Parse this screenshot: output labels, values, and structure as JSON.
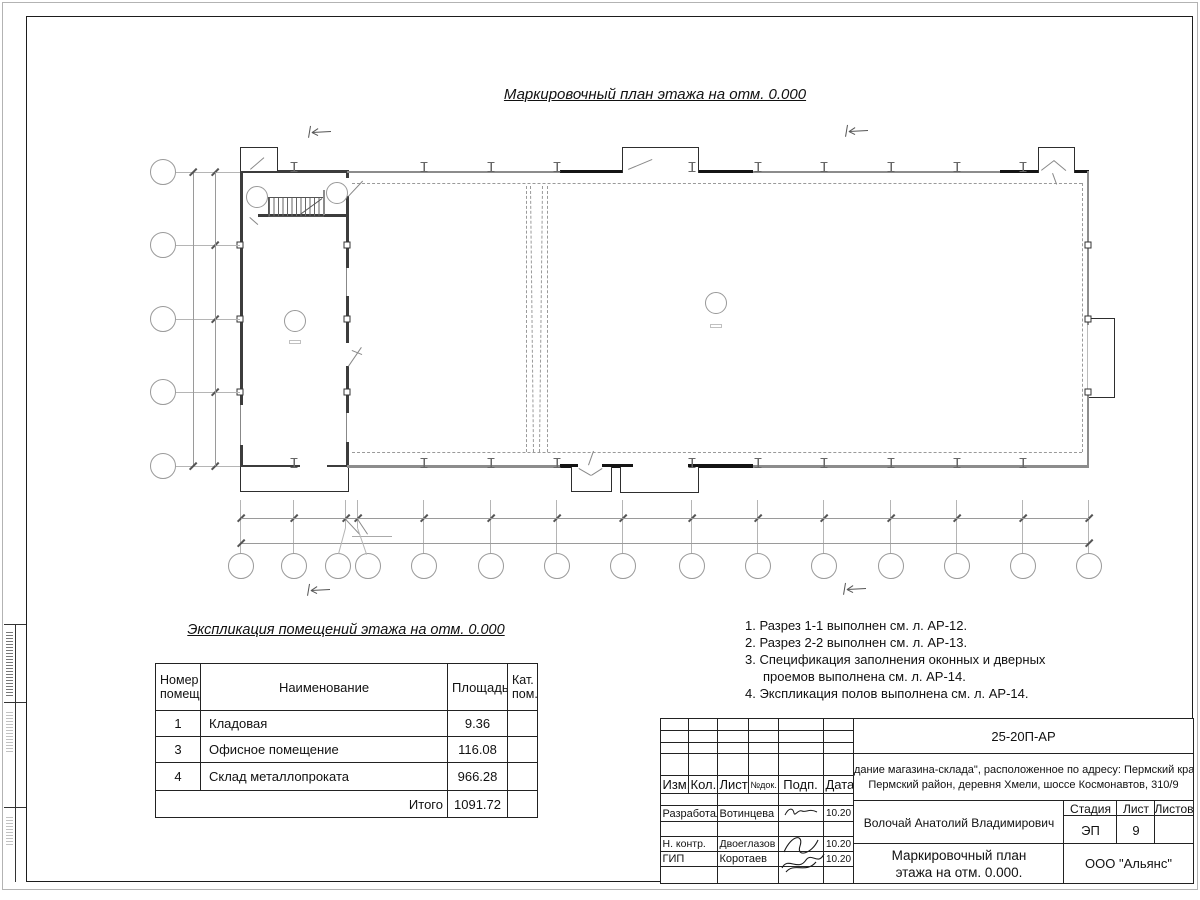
{
  "title": "Маркировочный план этажа на отм. 0.000",
  "plan": {
    "axes_numbers": [
      "1",
      "2",
      "3",
      "4",
      "5",
      "6",
      "7",
      "8",
      "9",
      "10",
      "11",
      "12",
      "13",
      "14",
      "15"
    ],
    "axes_letters": [
      "Д",
      "Г",
      "В",
      "Б",
      "А"
    ],
    "dims_bottom": [
      "3500",
      "3500",
      "4400",
      "4400",
      "4400",
      "4400",
      "4600",
      "4400",
      "4400",
      "4400",
      "4400",
      "4400",
      "4400"
    ],
    "dim_small": "800",
    "dim_total_bottom": "56400",
    "dims_left": [
      "4900",
      "4900",
      "4900",
      "4900"
    ],
    "dim_total_left": "19600",
    "labels": {
      "d3_topleft": "Д3",
      "d4": "Д4",
      "d5": "Д5",
      "ok1_top": "ОК1",
      "v1_top": "В1",
      "ok2_top": "ОК2",
      "d3_topright": "Д3",
      "ok4_upper": "ОК4",
      "crane": "Q=5т",
      "d6": "Д6",
      "v1_right": "В1",
      "ok5_left": "ОК5",
      "ok4_lower": "ОК4",
      "ok5_bottom": "ОК5",
      "d1": "Д1",
      "ok1_bottom": "ОК1",
      "d2": "Д2",
      "v1_bottom": "В1",
      "ok2_bottom": "ОК2"
    },
    "room_tags": [
      "1",
      "2",
      "3",
      "4"
    ],
    "elevation": "0.000",
    "sections": {
      "s1": "1",
      "s2": "2"
    }
  },
  "expl_table": {
    "title": "Экспликация помещений этажа на отм. 0.000",
    "headers": [
      "Номер помещ.",
      "Наименование",
      "Площадь",
      "Кат. пом."
    ],
    "rows": [
      [
        "1",
        "Кладовая",
        "9.36",
        ""
      ],
      [
        "3",
        "Офисное помещение",
        "116.08",
        ""
      ],
      [
        "4",
        "Склад металлопроката",
        "966.28",
        ""
      ]
    ],
    "total_label": "Итого",
    "total_value": "1091.72"
  },
  "notes": [
    "1. Разрез 1-1 выполнен см. л. АР-12.",
    "2. Разрез 2-2 выполнен см. л. АР-13.",
    "3. Спецификация заполнения оконных и дверных проемов выполнена см. л. АР-14.",
    "4. Экспликация полов выполнена см. л. АР-14."
  ],
  "titleblock": {
    "doc_code": "25-20П-АР",
    "project_line1": "\"Здание магазина-склада\", расположенное по адресу: Пермский край,",
    "project_line2": "Пермский район, деревня Хмели, шоссе Космонавтов, 310/9",
    "header_cols": [
      "Изм.",
      "Кол.",
      "Лист",
      "№док.",
      "Подп.",
      "Дата"
    ],
    "sign_rows": [
      [
        "Разработал",
        "Вотинцева",
        "10.20"
      ],
      [
        "Н. контр.",
        "Двоеглазов",
        "10.20"
      ],
      [
        "ГИП",
        "Коротаев",
        "10.20"
      ]
    ],
    "supervisor": "Волочай Анатолий Владимирович",
    "drawing_name_line1": "Маркировочный план",
    "drawing_name_line2": "этажа на отм. 0.000.",
    "stage_label": "Стадия",
    "sheet_label": "Лист",
    "sheets_label": "Листов",
    "stage": "ЭП",
    "sheet_no": "9",
    "sheets_total": "",
    "company": "ООО \"Альянс\""
  }
}
